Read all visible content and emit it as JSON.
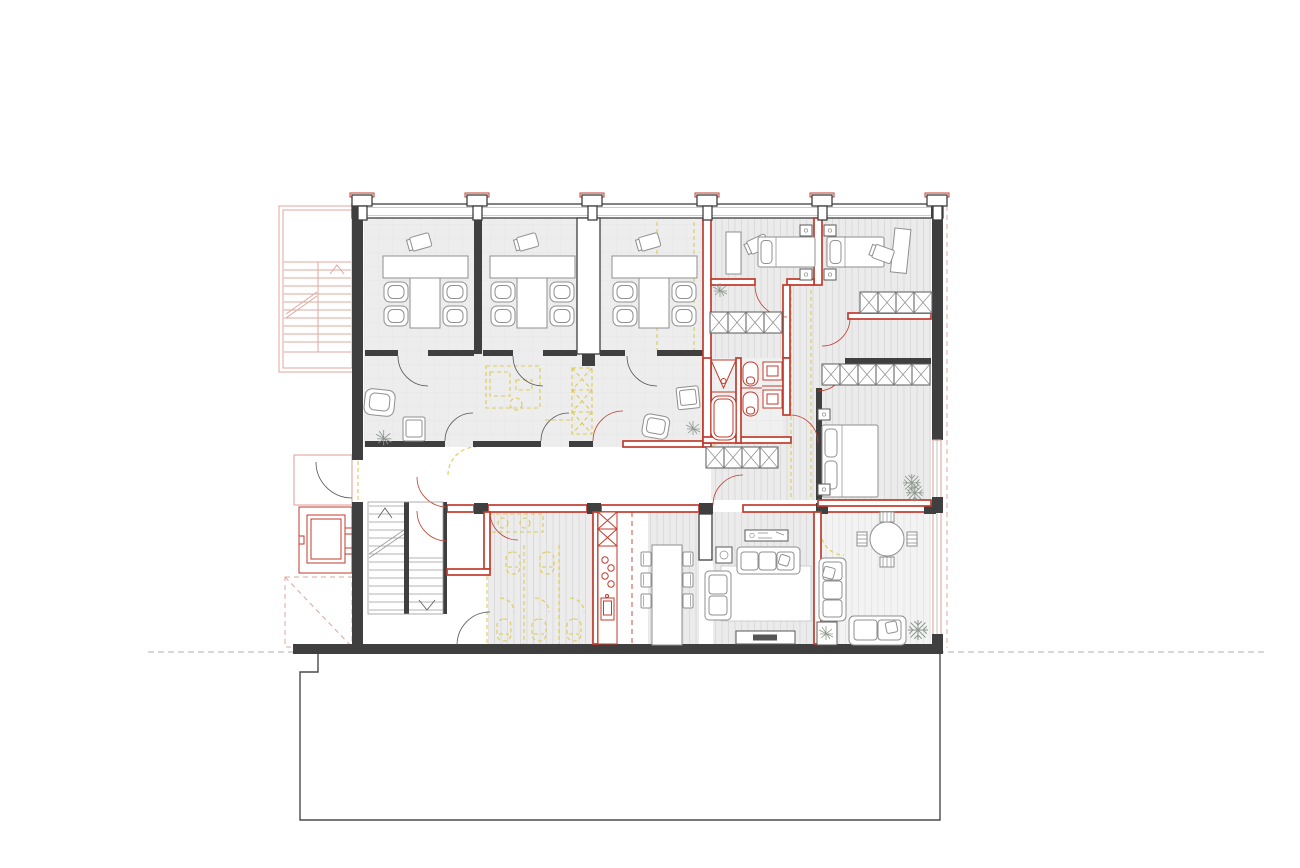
{
  "drawing": {
    "kind": "architectural-floor-plan",
    "canvas": {
      "width": 1300,
      "height": 868
    }
  },
  "palette": {
    "wall_dark": "#3f3f3f",
    "new_red": "#c23b2d",
    "exist_red": "#dfa79e",
    "demo_yellow": "#ddca55",
    "furn": "#8f8f8f",
    "floor_gray": "#ededed",
    "hatch_gray": "#d7d7d7",
    "floor_light": "#f3f3f3",
    "site_gray": "#bdbdbd",
    "paper": "#ffffff"
  },
  "color_meaning": {
    "dark_gray": "solid walls",
    "red": "red-drawn walls and fixtures",
    "light_red": "exterior stair, porch, elevator, canopy outlines",
    "yellow_dashed": "dashed demolition marks",
    "gray_hatch": "hatched floor areas"
  },
  "structure": {
    "facade_columns": 6,
    "window_bands": [
      "top-facade",
      "right-facade-lower"
    ]
  },
  "exterior": {
    "structures": [
      "external-stair",
      "entrance-porch",
      "elevator-shaft",
      "canopy-dashed"
    ],
    "site": [
      "boundary-dashed-line",
      "lower-building-outline"
    ]
  },
  "rooms": [
    {
      "name": "office-1",
      "furniture": [
        "l-shaped-desk",
        "task-chair",
        "armchair x4"
      ]
    },
    {
      "name": "office-2",
      "furniture": [
        "l-shaped-desk",
        "task-chair",
        "armchair x4"
      ]
    },
    {
      "name": "office-3",
      "furniture": [
        "l-shaped-desk",
        "task-chair",
        "armchair x4"
      ]
    },
    {
      "name": "lounge-strip",
      "furniture": [
        "armchair x2",
        "side-chair x2",
        "plant x2"
      ]
    },
    {
      "name": "bedroom-left",
      "furniture": [
        "single-bed",
        "desk",
        "chair",
        "nightstand x2",
        "plant"
      ]
    },
    {
      "name": "bedroom-right",
      "furniture": [
        "single-bed",
        "desk",
        "chair",
        "nightstand x2",
        "wardrobe-4"
      ]
    },
    {
      "name": "hallway",
      "furniture": [
        "wardrobe-4 x2"
      ]
    },
    {
      "name": "bathroom",
      "fixtures": [
        "shower",
        "bathtub",
        "toilet x2",
        "washbasin x2"
      ]
    },
    {
      "name": "double-bedroom",
      "furniture": [
        "double-bed",
        "nightstand x2",
        "wardrobe-6",
        "plant"
      ]
    },
    {
      "name": "corridor",
      "furniture": []
    },
    {
      "name": "stair-hall",
      "elements": [
        "u-shaped-stair",
        "elevator",
        "entrance-door"
      ]
    },
    {
      "name": "wc-demolition-zone",
      "fixtures_dashed": [
        "toilet x5",
        "washbasin-counter",
        "stall-partitions"
      ]
    },
    {
      "name": "kitchen",
      "fixtures": [
        "tall-unit x2",
        "counter",
        "hob-4-burners",
        "sink"
      ]
    },
    {
      "name": "dining",
      "furniture": [
        "long-table",
        "chair x6"
      ]
    },
    {
      "name": "living",
      "furniture": [
        "sofa-3-seat",
        "chaise",
        "rug",
        "tv-lowboard",
        "media-unit",
        "console"
      ]
    },
    {
      "name": "garden-room",
      "furniture": [
        "round-table",
        "chair x4",
        "sofa x2",
        "planter",
        "plant x2"
      ]
    }
  ]
}
